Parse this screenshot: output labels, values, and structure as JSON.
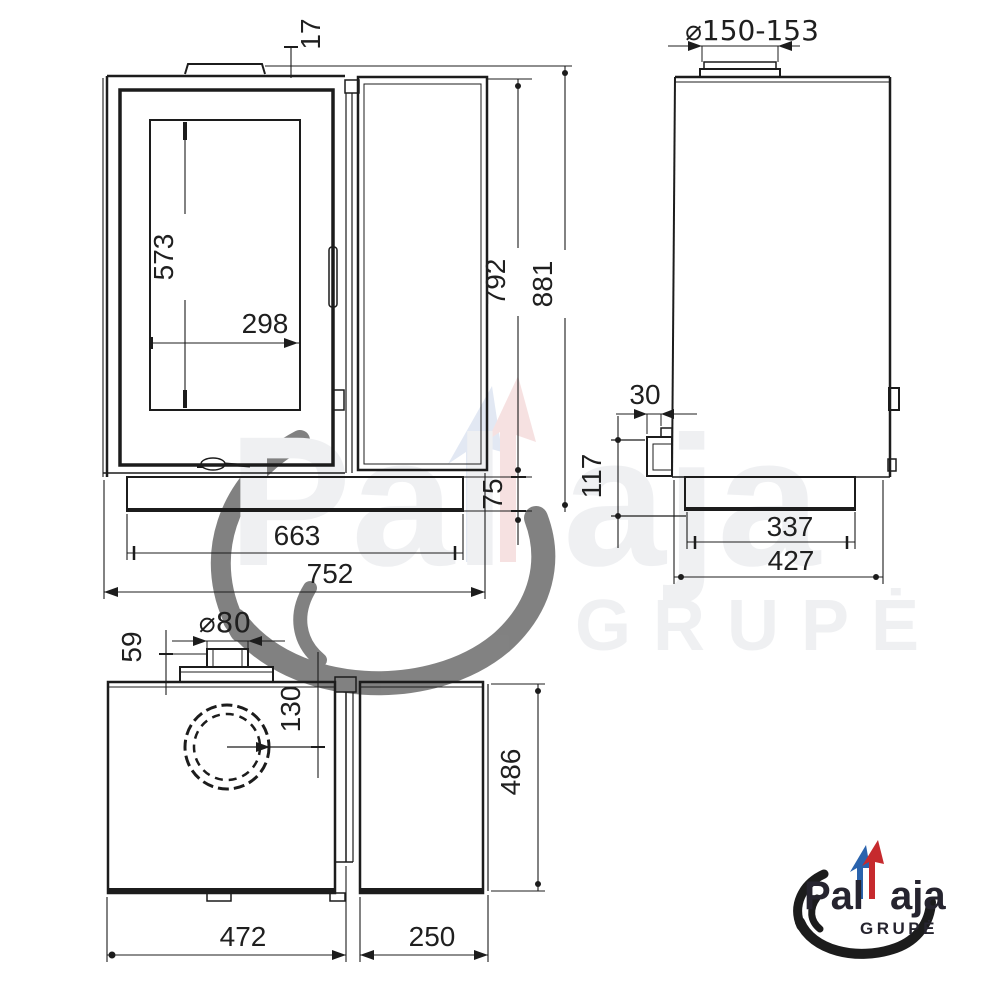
{
  "page": {
    "background": "#ffffff"
  },
  "colors": {
    "line": "#1c1c1c",
    "logo_blue": "#2a63ad",
    "logo_red": "#c62a2e",
    "logo_yellow": "#edc41f",
    "logo_text": "#26242f",
    "watermark_gray": "#e3e5e9"
  },
  "front_view": {
    "dims": {
      "top_plate_thickness": "17",
      "glass_height": "573",
      "glass_width": "298",
      "body_height": "792",
      "total_height": "881",
      "plinth_height": "75",
      "plinth_width": "663",
      "total_width": "752"
    }
  },
  "side_view": {
    "dims": {
      "flue_diameter": "⌀150-153",
      "rear_stub_depth": "30",
      "rear_stub_height": "117",
      "plinth_depth": "337",
      "total_depth": "427"
    }
  },
  "top_view": {
    "dims": {
      "intake_diameter": "⌀80",
      "intake_offset": "59",
      "intake_center_offset": "130",
      "side_panel_depth": "486",
      "body_width": "472",
      "side_panel_width": "250"
    }
  },
  "logo": {
    "brand_prefix": "Pal",
    "brand_suffix": "aja",
    "subtitle": "GRUPĖ"
  },
  "watermark": {
    "brand_prefix": "Pal",
    "brand_suffix": "aja",
    "subtitle": "GRUPĖ"
  }
}
